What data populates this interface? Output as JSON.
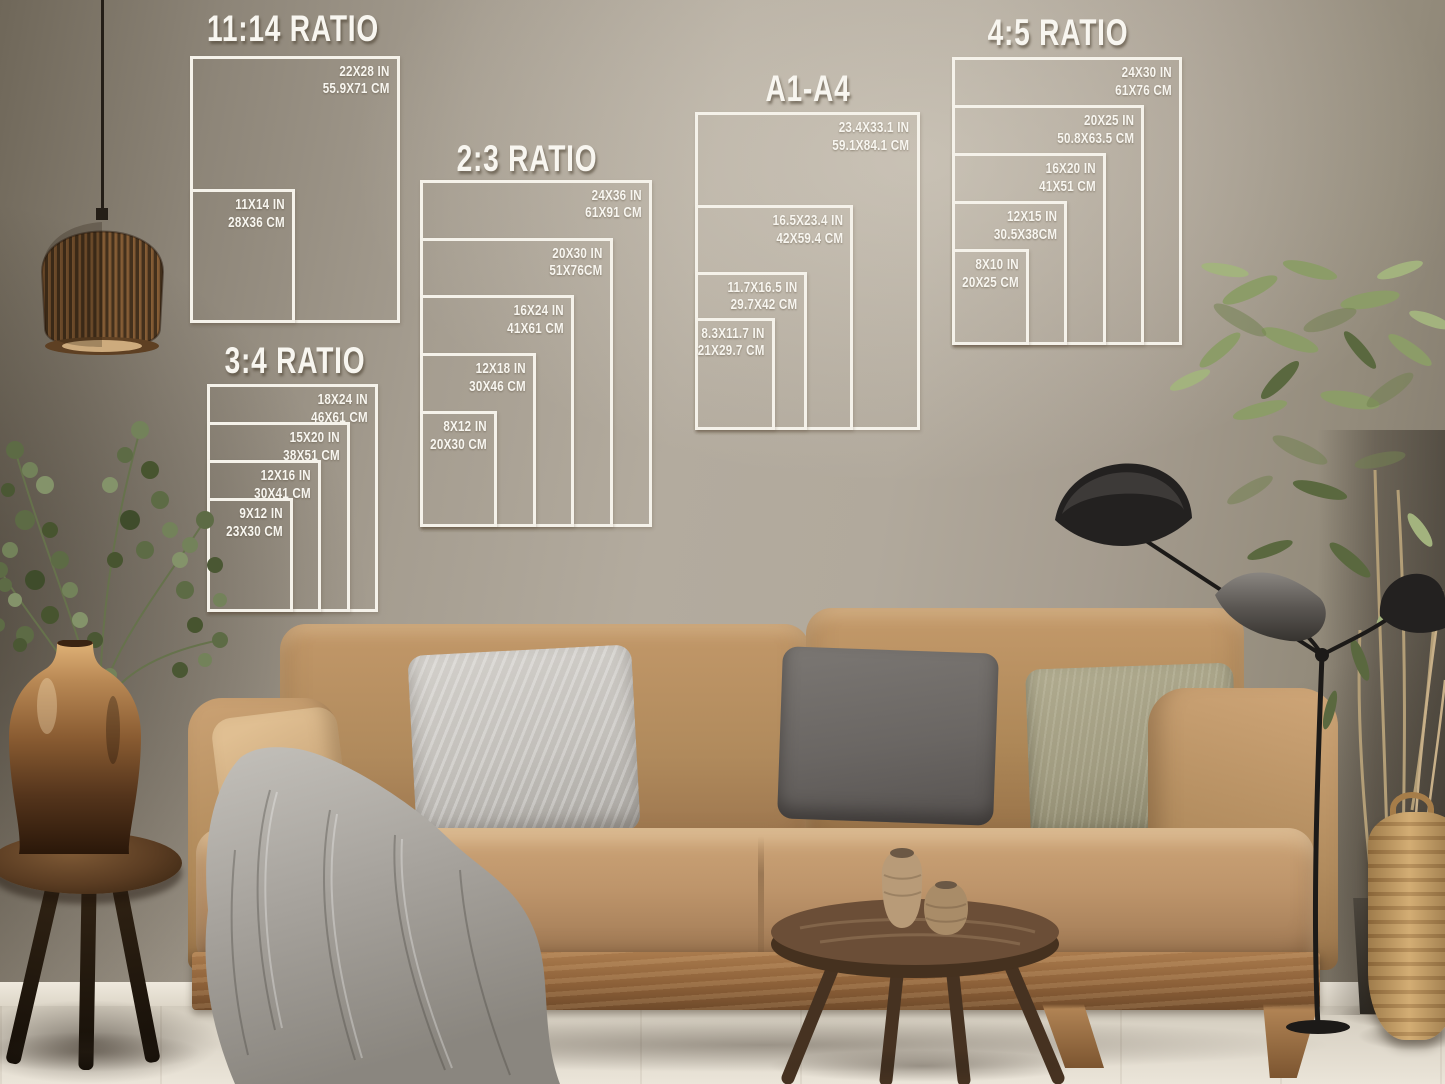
{
  "page_title": "Poster size guide mockup - living room wall",
  "size_guide": {
    "line_color": "#f5f2ea",
    "text_color": "#f8f6f0",
    "groups": [
      {
        "title": "11:14 RATIO",
        "anchor": {
          "left": 190,
          "bottom": 323
        },
        "px_per_inch": 9.55,
        "title_pos": {
          "cx": 293,
          "top": 8
        },
        "sizes": [
          {
            "w_in": 22,
            "h_in": 28,
            "label_in": "22X28 IN",
            "label_cm": "55.9X71 CM"
          },
          {
            "w_in": 11,
            "h_in": 14,
            "label_in": "11X14 IN",
            "label_cm": "28X36 CM"
          }
        ]
      },
      {
        "title": "2:3 RATIO",
        "anchor": {
          "left": 420,
          "bottom": 527
        },
        "px_per_inch": 9.65,
        "title_pos": {
          "cx": 527,
          "top": 138
        },
        "sizes": [
          {
            "w_in": 24,
            "h_in": 36,
            "label_in": "24X36 IN",
            "label_cm": "61X91 CM"
          },
          {
            "w_in": 20,
            "h_in": 30,
            "label_in": "20X30 IN",
            "label_cm": "51X76CM"
          },
          {
            "w_in": 16,
            "h_in": 24,
            "label_in": "16X24 IN",
            "label_cm": "41X61 CM"
          },
          {
            "w_in": 12,
            "h_in": 18,
            "label_in": "12X18 IN",
            "label_cm": "30X46 CM"
          },
          {
            "w_in": 8,
            "h_in": 12,
            "label_in": "8X12 IN",
            "label_cm": "20X30 CM"
          }
        ]
      },
      {
        "title": "3:4 RATIO",
        "anchor": {
          "left": 207,
          "bottom": 612
        },
        "px_per_inch": 9.5,
        "title_pos": {
          "cx": 295,
          "top": 340
        },
        "sizes": [
          {
            "w_in": 18,
            "h_in": 24,
            "label_in": "18X24 IN",
            "label_cm": "46X61 CM"
          },
          {
            "w_in": 15,
            "h_in": 20,
            "label_in": "15X20 IN",
            "label_cm": "38X51 CM"
          },
          {
            "w_in": 12,
            "h_in": 16,
            "label_in": "12X16 IN",
            "label_cm": "30X41 CM"
          },
          {
            "w_in": 9,
            "h_in": 12,
            "label_in": "9X12 IN",
            "label_cm": "23X30 CM"
          }
        ]
      },
      {
        "title": "A1-A4",
        "anchor": {
          "left": 695,
          "bottom": 430
        },
        "px_per_inch": 9.6,
        "title_pos": {
          "cx": 808,
          "top": 68
        },
        "sizes": [
          {
            "w_in": 23.4,
            "h_in": 33.1,
            "label_in": "23.4X33.1 IN",
            "label_cm": "59.1X84.1 CM"
          },
          {
            "w_in": 16.5,
            "h_in": 23.4,
            "label_in": "16.5X23.4 IN",
            "label_cm": "42X59.4 CM"
          },
          {
            "w_in": 11.7,
            "h_in": 16.5,
            "label_in": "11.7X16.5 IN",
            "label_cm": "29.7X42 CM"
          },
          {
            "w_in": 8.3,
            "h_in": 11.7,
            "label_in": "8.3X11.7 IN",
            "label_cm": "21X29.7 CM"
          }
        ]
      },
      {
        "title": "4:5 RATIO",
        "anchor": {
          "left": 952,
          "bottom": 345
        },
        "px_per_inch": 9.6,
        "title_pos": {
          "cx": 1058,
          "top": 12
        },
        "sizes": [
          {
            "w_in": 24,
            "h_in": 30,
            "label_in": "24X30 IN",
            "label_cm": "61X76 CM"
          },
          {
            "w_in": 20,
            "h_in": 25,
            "label_in": "20X25 IN",
            "label_cm": "50.8X63.5 CM"
          },
          {
            "w_in": 16,
            "h_in": 20,
            "label_in": "16X20 IN",
            "label_cm": "41X51 CM"
          },
          {
            "w_in": 12,
            "h_in": 15,
            "label_in": "12X15 IN",
            "label_cm": "30.5X38CM"
          },
          {
            "w_in": 8,
            "h_in": 10,
            "label_in": "8X10 IN",
            "label_cm": "20X25 CM"
          }
        ]
      }
    ]
  },
  "palette": {
    "wall": "#aba294",
    "wall_shadow": "#6f6759",
    "sofa_fabric": "#b58c5e",
    "sofa_wood": "#8d6139",
    "pillow_gray": "#c2bfba",
    "pillow_dark": "#6a6663",
    "pillow_olive": "#a09b80",
    "blanket": "#a6a29c",
    "bronze_vase": "#9a6a3c",
    "plant_green": "#74845a",
    "lamp_black": "#211f1e",
    "floor": "#e0d9cc",
    "overlay_line": "#f5f2ea"
  }
}
